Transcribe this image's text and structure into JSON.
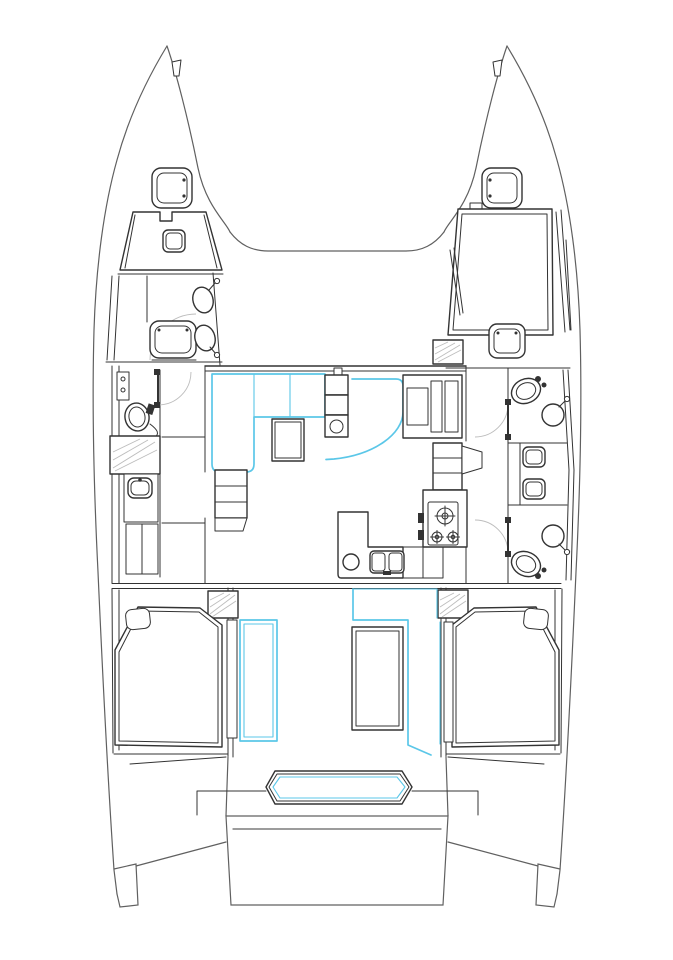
{
  "document": {
    "kind": "catamaran-yacht-deck-plan",
    "orientation": "bow-up-stern-down",
    "visible_text": "none"
  },
  "colors": {
    "paper": "#ffffff",
    "ink": "#333333",
    "hull_line": "#606060",
    "accent_cyan": "#5bc7e8",
    "light_line": "#bdbdbd"
  },
  "legend": {
    "accent_cyan_meaning": "highlighted soft furnishings and sliding/opening doors",
    "light_line_meaning": "door swing arcs and hatching"
  },
  "regions": {
    "foredeck": [
      "bow-cleat-port",
      "bow-cleat-starboard",
      "fore-deck-hatch-port",
      "fore-deck-hatch-starboard",
      "trampoline-curve"
    ],
    "port_hull": [
      "forward-berth",
      "berth-hatch",
      "vanity-basin-1",
      "vanity-basin-2",
      "hull-window-hatch",
      "head-toilet",
      "shower-tray",
      "wash-basin",
      "wardrobe",
      "companionway-steps",
      "aft-double-berth",
      "pillow",
      "sliding-cabin-door"
    ],
    "saloon": [
      "front-window-wall",
      "l-shaped-sofa",
      "saloon-table",
      "sideboard-with-sink",
      "curved-settee",
      "nav-station",
      "companionway-steps-starboard"
    ],
    "galley": [
      "l-shaped-counter",
      "round-sink",
      "double-sink",
      "three-burner-cooktop",
      "control-knobs"
    ],
    "starboard_hull": [
      "forward-double-berth",
      "berth-foot-hatch",
      "side-rails",
      "entry-steps",
      "forward-head-toilet",
      "forward-head-basin",
      "mid-cabinet-hatches",
      "aft-head-toilet",
      "aft-head-basin",
      "head-doors",
      "aft-double-berth",
      "pillow"
    ],
    "cockpit": [
      "hatched-step-boxes",
      "sliding-door-panels",
      "cockpit-table",
      "aft-bench",
      "transom-steps",
      "swim-platform"
    ]
  }
}
